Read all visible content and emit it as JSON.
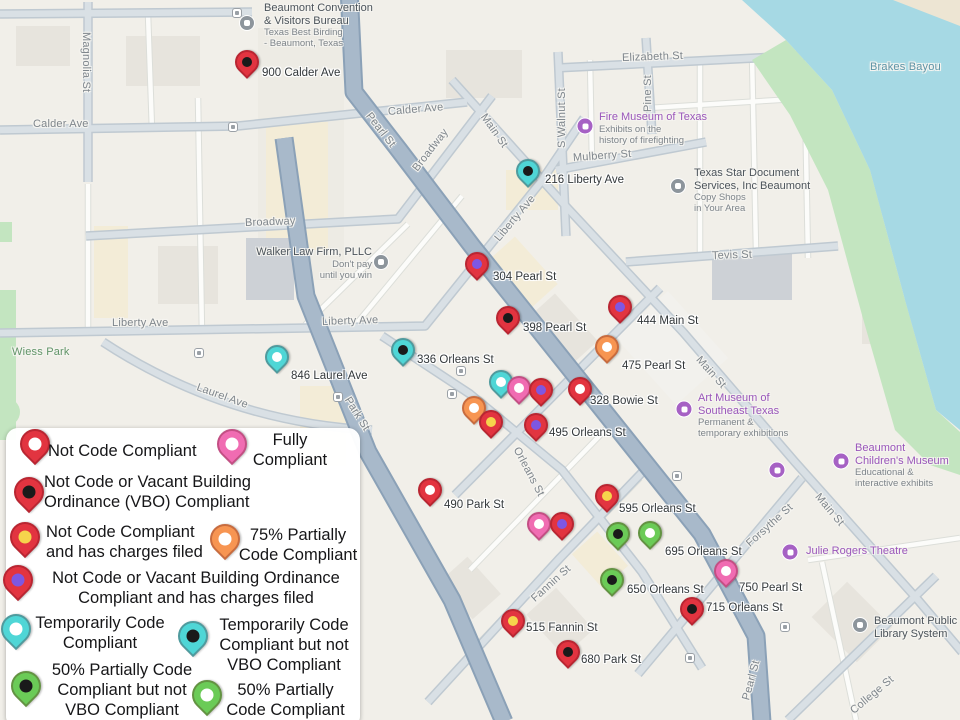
{
  "map": {
    "region": "Downtown Beaumont, Texas",
    "colors": {
      "background": "#f1efe9",
      "water": "#a6d9e4",
      "park": "#c3e5c0",
      "road_major": "#a8b9ca",
      "road_arterial": "#d9e0e5",
      "road_minor": "#fcfcfa",
      "poi_purple": "#9a56ba",
      "poi_gray": "#4c545b"
    },
    "street_labels": [
      {
        "text": "Magnolia St",
        "x": 86,
        "y": 32,
        "rot": 90
      },
      {
        "text": "Calder Ave",
        "x": 33,
        "y": 124,
        "rot": 0
      },
      {
        "text": "Calder Ave",
        "x": 388,
        "y": 112,
        "rot": -5
      },
      {
        "text": "Broadway",
        "x": 245,
        "y": 223,
        "rot": -2
      },
      {
        "text": "Broadway",
        "x": 415,
        "y": 170,
        "rot": -52
      },
      {
        "text": "Pearl St",
        "x": 368,
        "y": 114,
        "rot": 52
      },
      {
        "text": "Main St",
        "x": 483,
        "y": 115,
        "rot": 55
      },
      {
        "text": "S Walnut St",
        "x": 562,
        "y": 148,
        "rot": -90
      },
      {
        "text": "Pine St",
        "x": 648,
        "y": 112,
        "rot": -90
      },
      {
        "text": "Elizabeth St",
        "x": 622,
        "y": 58,
        "rot": -2
      },
      {
        "text": "Mulberry St",
        "x": 573,
        "y": 158,
        "rot": -4
      },
      {
        "text": "Liberty Ave",
        "x": 497,
        "y": 240,
        "rot": -50
      },
      {
        "text": "Tevis St",
        "x": 712,
        "y": 256,
        "rot": -2
      },
      {
        "text": "Liberty Ave",
        "x": 112,
        "y": 323,
        "rot": 0
      },
      {
        "text": "Liberty Ave",
        "x": 322,
        "y": 322,
        "rot": -2
      },
      {
        "text": "Wiess Park",
        "x": 12,
        "y": 352,
        "rot": 0,
        "cls": "park"
      },
      {
        "text": "Laurel Ave",
        "x": 197,
        "y": 387,
        "rot": 20
      },
      {
        "text": "Park St",
        "x": 347,
        "y": 398,
        "rot": 58
      },
      {
        "text": "Orleans St",
        "x": 516,
        "y": 448,
        "rot": 62
      },
      {
        "text": "Fannin St",
        "x": 533,
        "y": 600,
        "rot": -42
      },
      {
        "text": "Main St",
        "x": 698,
        "y": 358,
        "rot": 48
      },
      {
        "text": "Forsythe St",
        "x": 748,
        "y": 545,
        "rot": -42
      },
      {
        "text": "Main St",
        "x": 817,
        "y": 495,
        "rot": 50
      },
      {
        "text": "Pearl St",
        "x": 746,
        "y": 700,
        "rot": -75
      },
      {
        "text": "College St",
        "x": 852,
        "y": 712,
        "rot": -40
      },
      {
        "text": "Brakes Bayou",
        "x": 870,
        "y": 67,
        "rot": 0,
        "cls": "water"
      }
    ],
    "pois": [
      {
        "kind": "gray",
        "icon": "building-icon",
        "ix": 247,
        "iy": 23,
        "tx": 264,
        "ty": 2,
        "title": "Beaumont Convention\n& Visitors Bureau",
        "sub": "Texas Best Birding\n- Beaumont, Texas"
      },
      {
        "kind": "purple",
        "icon": "museum-icon",
        "ix": 585,
        "iy": 126,
        "tx": 599,
        "ty": 111,
        "title": "Fire Museum of Texas",
        "sub": "Exhibits on the\nhistory of firefighting"
      },
      {
        "kind": "gray",
        "icon": "shop-icon",
        "ix": 678,
        "iy": 186,
        "tx": 694,
        "ty": 167,
        "title": "Texas Star Document\nServices, Inc Beaumont",
        "sub": "Copy Shops\nin Your Area"
      },
      {
        "kind": "gray",
        "icon": "briefcase-icon",
        "ix": 381,
        "iy": 262,
        "tx": 372,
        "ty": 246,
        "align": "right",
        "title": "Walker Law Firm, PLLC",
        "sub": "Don't pay\nuntil you win"
      },
      {
        "kind": "purple",
        "icon": "museum-icon",
        "ix": 684,
        "iy": 409,
        "tx": 698,
        "ty": 392,
        "title": "Art Museum of\nSoutheast Texas",
        "sub": "Permanent &\ntemporary exhibitions"
      },
      {
        "kind": "purple",
        "icon": "museum-icon",
        "ix": 841,
        "iy": 461,
        "tx": 855,
        "ty": 442,
        "title": "Beaumont\nChildren's Museum",
        "sub": "Educational &\ninteractive exhibits"
      },
      {
        "kind": "purple",
        "icon": "theatre-icon",
        "ix": 790,
        "iy": 552,
        "tx": 806,
        "ty": 545,
        "title": "Julie Rogers Theatre",
        "sub": ""
      },
      {
        "kind": "gray",
        "icon": "library-icon",
        "ix": 860,
        "iy": 625,
        "tx": 874,
        "ty": 615,
        "title": "Beaumont Public\nLibrary System",
        "sub": ""
      },
      {
        "kind": "purple",
        "icon": "museum-icon",
        "ix": 777,
        "iy": 470,
        "tx": 0,
        "ty": 0,
        "title": "",
        "sub": ""
      }
    ],
    "transit_stops": [
      {
        "x": 237,
        "y": 13
      },
      {
        "x": 233,
        "y": 127
      },
      {
        "x": 199,
        "y": 353
      },
      {
        "x": 338,
        "y": 397
      },
      {
        "x": 461,
        "y": 371
      },
      {
        "x": 452,
        "y": 394
      },
      {
        "x": 677,
        "y": 476
      },
      {
        "x": 690,
        "y": 658
      },
      {
        "x": 785,
        "y": 627
      }
    ],
    "pins": [
      {
        "type": "red-black",
        "x": 247,
        "y": 62,
        "label": "900 Calder Ave",
        "lx": 262,
        "ly": 67
      },
      {
        "type": "teal-black",
        "x": 528,
        "y": 171,
        "label": "216 Liberty Ave",
        "lx": 545,
        "ly": 174
      },
      {
        "type": "red-purple",
        "x": 477,
        "y": 264,
        "label": "304 Pearl St",
        "lx": 493,
        "ly": 271
      },
      {
        "type": "red-black",
        "x": 508,
        "y": 318,
        "label": "398 Pearl St",
        "lx": 523,
        "ly": 322
      },
      {
        "type": "red-purple",
        "x": 620,
        "y": 307,
        "label": "444 Main St",
        "lx": 637,
        "ly": 315
      },
      {
        "type": "orange-white",
        "x": 607,
        "y": 347,
        "label": "475 Pearl St",
        "lx": 622,
        "ly": 360
      },
      {
        "type": "teal-black",
        "x": 403,
        "y": 350,
        "label": "336 Orleans St",
        "lx": 417,
        "ly": 354
      },
      {
        "type": "teal-white",
        "x": 277,
        "y": 357,
        "label": "846 Laurel Ave",
        "lx": 291,
        "ly": 370
      },
      {
        "type": "teal-white",
        "x": 501,
        "y": 382,
        "label": "",
        "lx": 0,
        "ly": 0
      },
      {
        "type": "pink-white",
        "x": 519,
        "y": 388,
        "label": "",
        "lx": 0,
        "ly": 0
      },
      {
        "type": "red-purple",
        "x": 541,
        "y": 390,
        "label": "",
        "lx": 0,
        "ly": 0
      },
      {
        "type": "red-white",
        "x": 580,
        "y": 389,
        "label": "328 Bowie St",
        "lx": 590,
        "ly": 395
      },
      {
        "type": "orange-white",
        "x": 474,
        "y": 408,
        "label": "",
        "lx": 0,
        "ly": 0
      },
      {
        "type": "red-yellow",
        "x": 491,
        "y": 422,
        "label": "",
        "lx": 0,
        "ly": 0
      },
      {
        "type": "red-purple",
        "x": 536,
        "y": 425,
        "label": "495 Orleans St",
        "lx": 549,
        "ly": 427
      },
      {
        "type": "red-white",
        "x": 430,
        "y": 490,
        "label": "490 Park St",
        "lx": 444,
        "ly": 499
      },
      {
        "type": "red-yellow",
        "x": 607,
        "y": 496,
        "label": "595 Orleans St",
        "lx": 619,
        "ly": 503
      },
      {
        "type": "pink-white",
        "x": 539,
        "y": 524,
        "label": "",
        "lx": 0,
        "ly": 0
      },
      {
        "type": "red-purple",
        "x": 562,
        "y": 524,
        "label": "",
        "lx": 0,
        "ly": 0
      },
      {
        "type": "green-black",
        "x": 618,
        "y": 534,
        "label": "",
        "lx": 0,
        "ly": 0
      },
      {
        "type": "green-white",
        "x": 650,
        "y": 533,
        "label": "695 Orleans St",
        "lx": 665,
        "ly": 546
      },
      {
        "type": "green-black",
        "x": 612,
        "y": 580,
        "label": "650 Orleans St",
        "lx": 627,
        "ly": 584
      },
      {
        "type": "pink-white",
        "x": 726,
        "y": 571,
        "label": "750 Pearl St",
        "lx": 739,
        "ly": 582
      },
      {
        "type": "red-black",
        "x": 692,
        "y": 609,
        "label": "715 Orleans St",
        "lx": 706,
        "ly": 602
      },
      {
        "type": "red-yellow",
        "x": 513,
        "y": 621,
        "label": "515 Fannin St",
        "lx": 526,
        "ly": 622
      },
      {
        "type": "red-black",
        "x": 568,
        "y": 652,
        "label": "680 Park St",
        "lx": 581,
        "ly": 654
      }
    ]
  },
  "pin_types": {
    "red-white": {
      "body": "#e23440",
      "dot": "#ffffff"
    },
    "red-black": {
      "body": "#e23440",
      "dot": "#1a1a1a"
    },
    "red-yellow": {
      "body": "#e23440",
      "dot": "#f6d44c"
    },
    "red-purple": {
      "body": "#e23440",
      "dot": "#7e57e2"
    },
    "pink-white": {
      "body": "#f06cb2",
      "dot": "#ffffff"
    },
    "orange-white": {
      "body": "#f79552",
      "dot": "#ffffff"
    },
    "teal-white": {
      "body": "#4fd6d6",
      "dot": "#ffffff"
    },
    "teal-black": {
      "body": "#4fd6d6",
      "dot": "#1a1a1a"
    },
    "green-black": {
      "body": "#6bcb57",
      "dot": "#1a1a1a"
    },
    "green-white": {
      "body": "#6bcb57",
      "dot": "#ffffff"
    }
  },
  "legend": {
    "items": [
      {
        "type": "red-white",
        "ix": 29,
        "iy": 16,
        "tx": 42,
        "ty": 13,
        "tw": 175,
        "align": "left",
        "text": "Not Code Compliant"
      },
      {
        "type": "pink-white",
        "ix": 226,
        "iy": 16,
        "tx": 234,
        "ty": 2,
        "tw": 100,
        "align": "center",
        "text": "Fully Compliant"
      },
      {
        "type": "red-black",
        "ix": 23,
        "iy": 64,
        "tx": 38,
        "ty": 44,
        "tw": 240,
        "align": "left",
        "text": "Not Code or Vacant Building Ordinance (VBO) Compliant"
      },
      {
        "type": "red-yellow",
        "ix": 19,
        "iy": 109,
        "tx": 40,
        "ty": 94,
        "tw": 170,
        "align": "left",
        "text": "Not Code Compliant and has charges filed"
      },
      {
        "type": "orange-white",
        "ix": 219,
        "iy": 111,
        "tx": 227,
        "ty": 97,
        "tw": 130,
        "align": "center",
        "text": "75% Partially Code Compliant"
      },
      {
        "type": "red-purple",
        "ix": 12,
        "iy": 152,
        "tx": 30,
        "ty": 140,
        "tw": 320,
        "align": "center",
        "text": "Not Code or Vacant Building Ordinance Compliant and has charges filed"
      },
      {
        "type": "teal-white",
        "ix": 10,
        "iy": 201,
        "tx": 24,
        "ty": 185,
        "tw": 140,
        "align": "center",
        "text": "Temporarily Code Compliant"
      },
      {
        "type": "teal-black",
        "ix": 187,
        "iy": 208,
        "tx": 199,
        "ty": 187,
        "tw": 158,
        "align": "center",
        "text": "Temporarily Code Compliant but not VBO Compliant"
      },
      {
        "type": "green-black",
        "ix": 20,
        "iy": 258,
        "tx": 36,
        "ty": 232,
        "tw": 160,
        "align": "center",
        "text": "50% Partially Code Compliant but not VBO Compliant"
      },
      {
        "type": "green-white",
        "ix": 201,
        "iy": 267,
        "tx": 212,
        "ty": 252,
        "tw": 135,
        "align": "center",
        "text": "50% Partially Code Compliant"
      }
    ]
  }
}
